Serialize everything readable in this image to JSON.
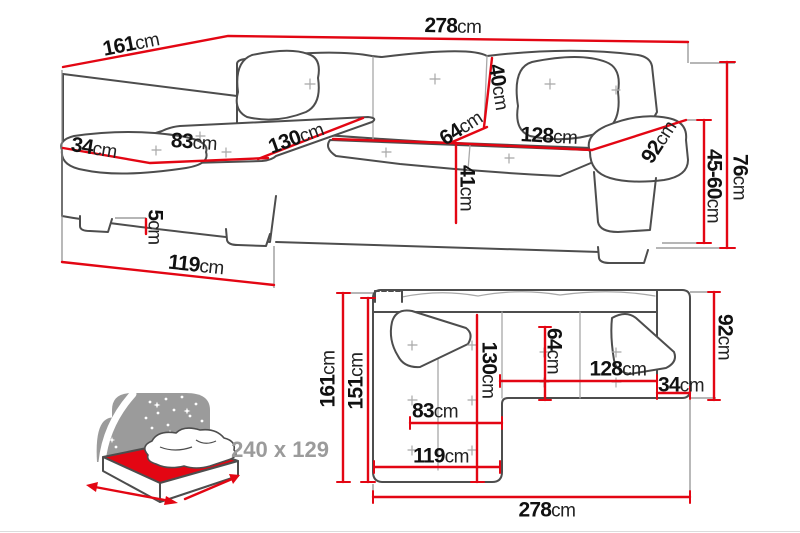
{
  "colors": {
    "accent_red": "#e30613",
    "outline_dark": "#4d4d4d",
    "seam_grey": "#a8a8a8",
    "icon_grey": "#9b9b9b"
  },
  "perspective_view": {
    "name": "corner sofa perspective view with dimensions",
    "labels": {
      "side_depth": {
        "value": "161",
        "unit": "cm"
      },
      "total_width": {
        "value": "278",
        "unit": "cm"
      },
      "armrest_width": {
        "value": "34",
        "unit": "cm"
      },
      "chaise_seat_width": {
        "value": "83",
        "unit": "cm"
      },
      "chaise_seat_length": {
        "value": "130",
        "unit": "cm"
      },
      "backrest_height": {
        "value": "40",
        "unit": "cm"
      },
      "seat_depth": {
        "value": "64",
        "unit": "cm"
      },
      "seat_width": {
        "value": "128",
        "unit": "cm"
      },
      "armrest_length": {
        "value": "92",
        "unit": "cm"
      },
      "seat_height": {
        "value": "41",
        "unit": "cm"
      },
      "leg_height": {
        "value": "5",
        "unit": "cm"
      },
      "chaise_front_length": {
        "value": "119",
        "unit": "cm"
      },
      "total_height": {
        "value": "76",
        "unit": "cm"
      },
      "armrest_height_range": {
        "value": "45-60",
        "unit": "cm"
      }
    }
  },
  "top_view": {
    "name": "corner sofa top view with dimensions",
    "labels": {
      "total_depth": {
        "value": "161",
        "unit": "cm"
      },
      "inner_depth": {
        "value": "151",
        "unit": "cm"
      },
      "chaise_length": {
        "value": "130",
        "unit": "cm"
      },
      "seat_depth": {
        "value": "64",
        "unit": "cm"
      },
      "seat_width": {
        "value": "128",
        "unit": "cm"
      },
      "armrest_width": {
        "value": "34",
        "unit": "cm"
      },
      "body_depth": {
        "value": "92",
        "unit": "cm"
      },
      "chaise_seat_width": {
        "value": "83",
        "unit": "cm"
      },
      "chaise_front_length": {
        "value": "119",
        "unit": "cm"
      },
      "total_width": {
        "value": "278",
        "unit": "cm"
      }
    }
  },
  "sleeping_function": {
    "icon": "bed-night-sky-icon",
    "bed_size": "240 x 129"
  }
}
